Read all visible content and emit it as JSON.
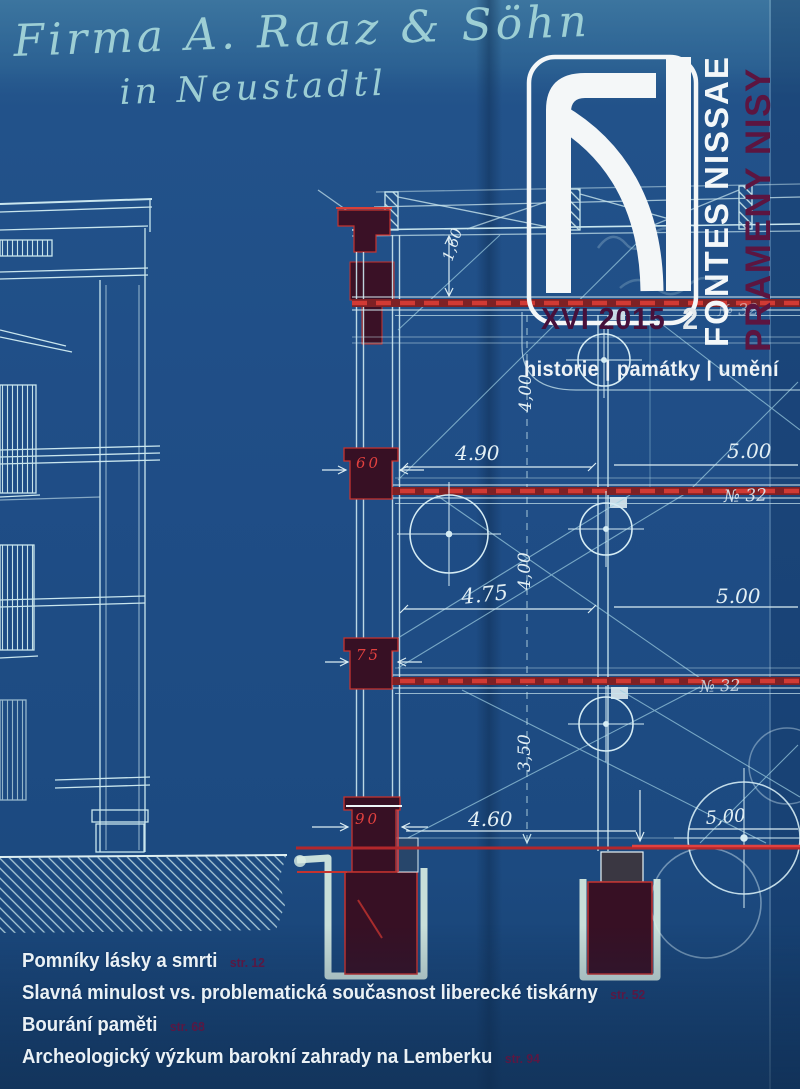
{
  "masthead": {
    "title": "FONTES NISSAE",
    "subtitle": "PRAMENY NISY",
    "volume": "XVI 2015",
    "number": "2",
    "tagline": "historie | památky | umění"
  },
  "contents": [
    {
      "title": "Pomníky lásky a smrti",
      "page": "str. 12"
    },
    {
      "title": "Slavná minulost vs. problematická současnost liberecké tiskárny",
      "page": "str. 52"
    },
    {
      "title": "Bourání paměti",
      "page": "str. 68"
    },
    {
      "title": "Archeologický výzkum barokní zahrady na Lemberku",
      "page": "str. 94"
    }
  ],
  "blueprint": {
    "handwriting": {
      "line1": "Firma A. Raaz & Söhn",
      "line2": "in Neustadtl"
    },
    "dimensions": {
      "d160": "1,60",
      "d490": "4.90",
      "d500_top": "5.00",
      "d400_upper": "4,00",
      "d475": "4.75",
      "d500_mid": "5.00",
      "d400_lower": "4,00",
      "d350": "3,50",
      "d460": "4.60",
      "d500_bottom": "5,00",
      "no32_top": "№ 32",
      "no32_mid": "№ 32",
      "no32_low": "№ 32",
      "b60": "60",
      "b75": "75",
      "b90": "90"
    }
  },
  "colors": {
    "paper_blue": "#1e4b85",
    "line_cyan": "#c9e6ee",
    "accent_red": "#c5332f",
    "block_maroon": "#371024",
    "title_maroon": "#5c1540",
    "white": "#f3f7f9"
  }
}
